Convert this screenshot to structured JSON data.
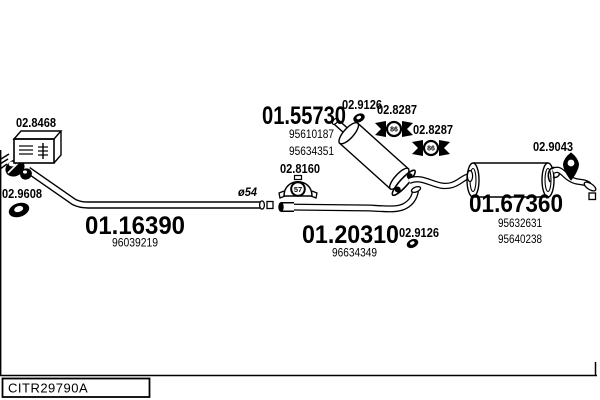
{
  "colors": {
    "background": "#ffffff",
    "line": "#000000"
  },
  "parts": {
    "front_pipe": {
      "code": "01.16390",
      "oem": "96039219"
    },
    "center_silencer": {
      "code": "01.55730",
      "oem_a": "95610187",
      "oem_b": "95634351"
    },
    "mid_pipe": {
      "code": "01.20310",
      "oem": "96634349"
    },
    "rear_silencer": {
      "code": "01.67360",
      "oem_a": "95632631",
      "oem_b": "95640238"
    }
  },
  "fittings": {
    "mounting_kit": {
      "code": "02.8468"
    },
    "front_gasket": {
      "code": "02.9608"
    },
    "pipe_clamp": {
      "code": "02.8160",
      "size": "57"
    },
    "center_gasket": {
      "code": "02.9126"
    },
    "hanger_a": {
      "code": "02.8287",
      "size": "86"
    },
    "hanger_b": {
      "code": "02.8287",
      "size": "86"
    },
    "mid_gasket": {
      "code": "02.9126"
    },
    "rear_hanger": {
      "code": "02.9043"
    }
  },
  "annotations": {
    "pipe_diameter": "ø54"
  },
  "footer": {
    "reference": "CITR29790A"
  }
}
